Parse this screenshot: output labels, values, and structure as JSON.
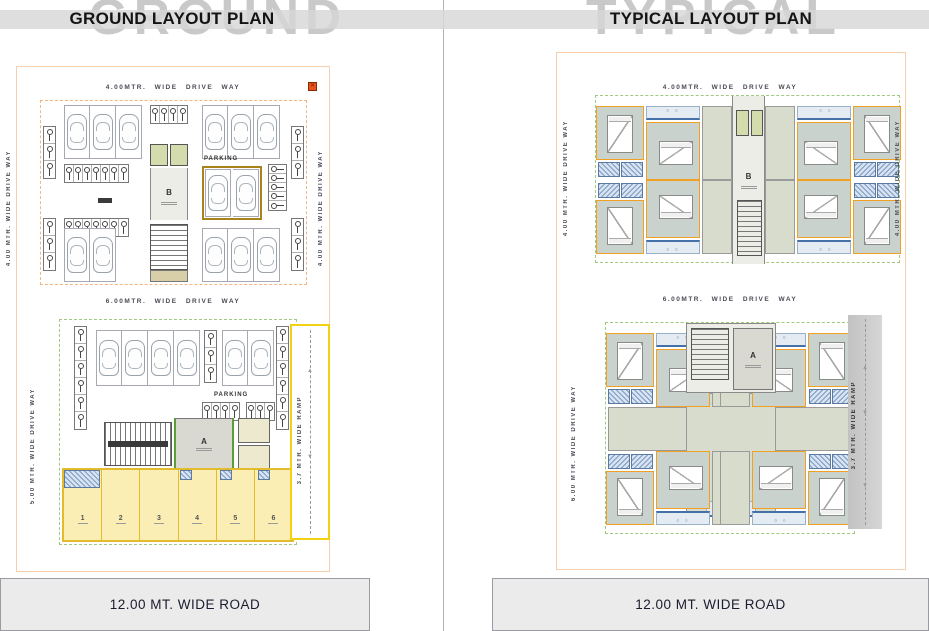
{
  "left": {
    "watermark": "GROUND",
    "title": "GROUND LAYOUT PLAN",
    "road_label": "12.00 MT. WIDE ROAD",
    "labels": {
      "drive_top": "4.00MTR. WIDE DRIVE WAY",
      "drive_left_upper": "4.00 MTR. WIDE DRIVE WAY",
      "drive_right_upper": "4.00 MTR. WIDE DRIVE WAY",
      "drive_mid": "6.00MTR. WIDE DRIVE WAY",
      "drive_left_lower": "5.00 MTR. WIDE DRIVE WAY",
      "ramp": "3.7 MTR. WIDE RAMP",
      "parking_upper": "PARKING",
      "parking_lower": "PARKING",
      "wing_b": "B",
      "wing_a": "A"
    },
    "shops": [
      "1",
      "2",
      "3",
      "4",
      "5",
      "6"
    ],
    "marker_glyph": "✕"
  },
  "right": {
    "watermark": "TYPICAL",
    "title": "TYPICAL LAYOUT PLAN",
    "road_label": "12.00 MT. WIDE ROAD",
    "labels": {
      "drive_top": "4.00MTR. WIDE DRIVE WAY",
      "drive_left_upper": "4.00 MTR. WIDE DRIVE WAY",
      "drive_right_upper": "4.00 MTR. WIDE DRIVE WAY",
      "drive_mid": "6.00MTR. WIDE DRIVE WAY",
      "drive_left_lower": "6.00 MTR. WIDE DRIVE WAY",
      "ramp": "3.7 MTR. WIDE RAMP",
      "wing_b": "B",
      "wing_a": "A"
    },
    "arrow_up": "▲",
    "arrow_down": "▼"
  },
  "colors": {
    "watermark_gray": "#c9c9c9",
    "boundary_peach": "#f5cfae",
    "road_gray": "#ebebeb",
    "marker_red": "#e8511c",
    "green_dash": "#9fc97f",
    "lift_green": "#d4dcae",
    "gold": "#a8821a",
    "shop_yellow": "#fbeeb4",
    "shop_border": "#e3bc2e",
    "ramp_yellow": "#f2d012",
    "hatch_blue": "#d6e3f2",
    "room_green": "#c9d2cc",
    "wall_orange": "#f0a124"
  }
}
